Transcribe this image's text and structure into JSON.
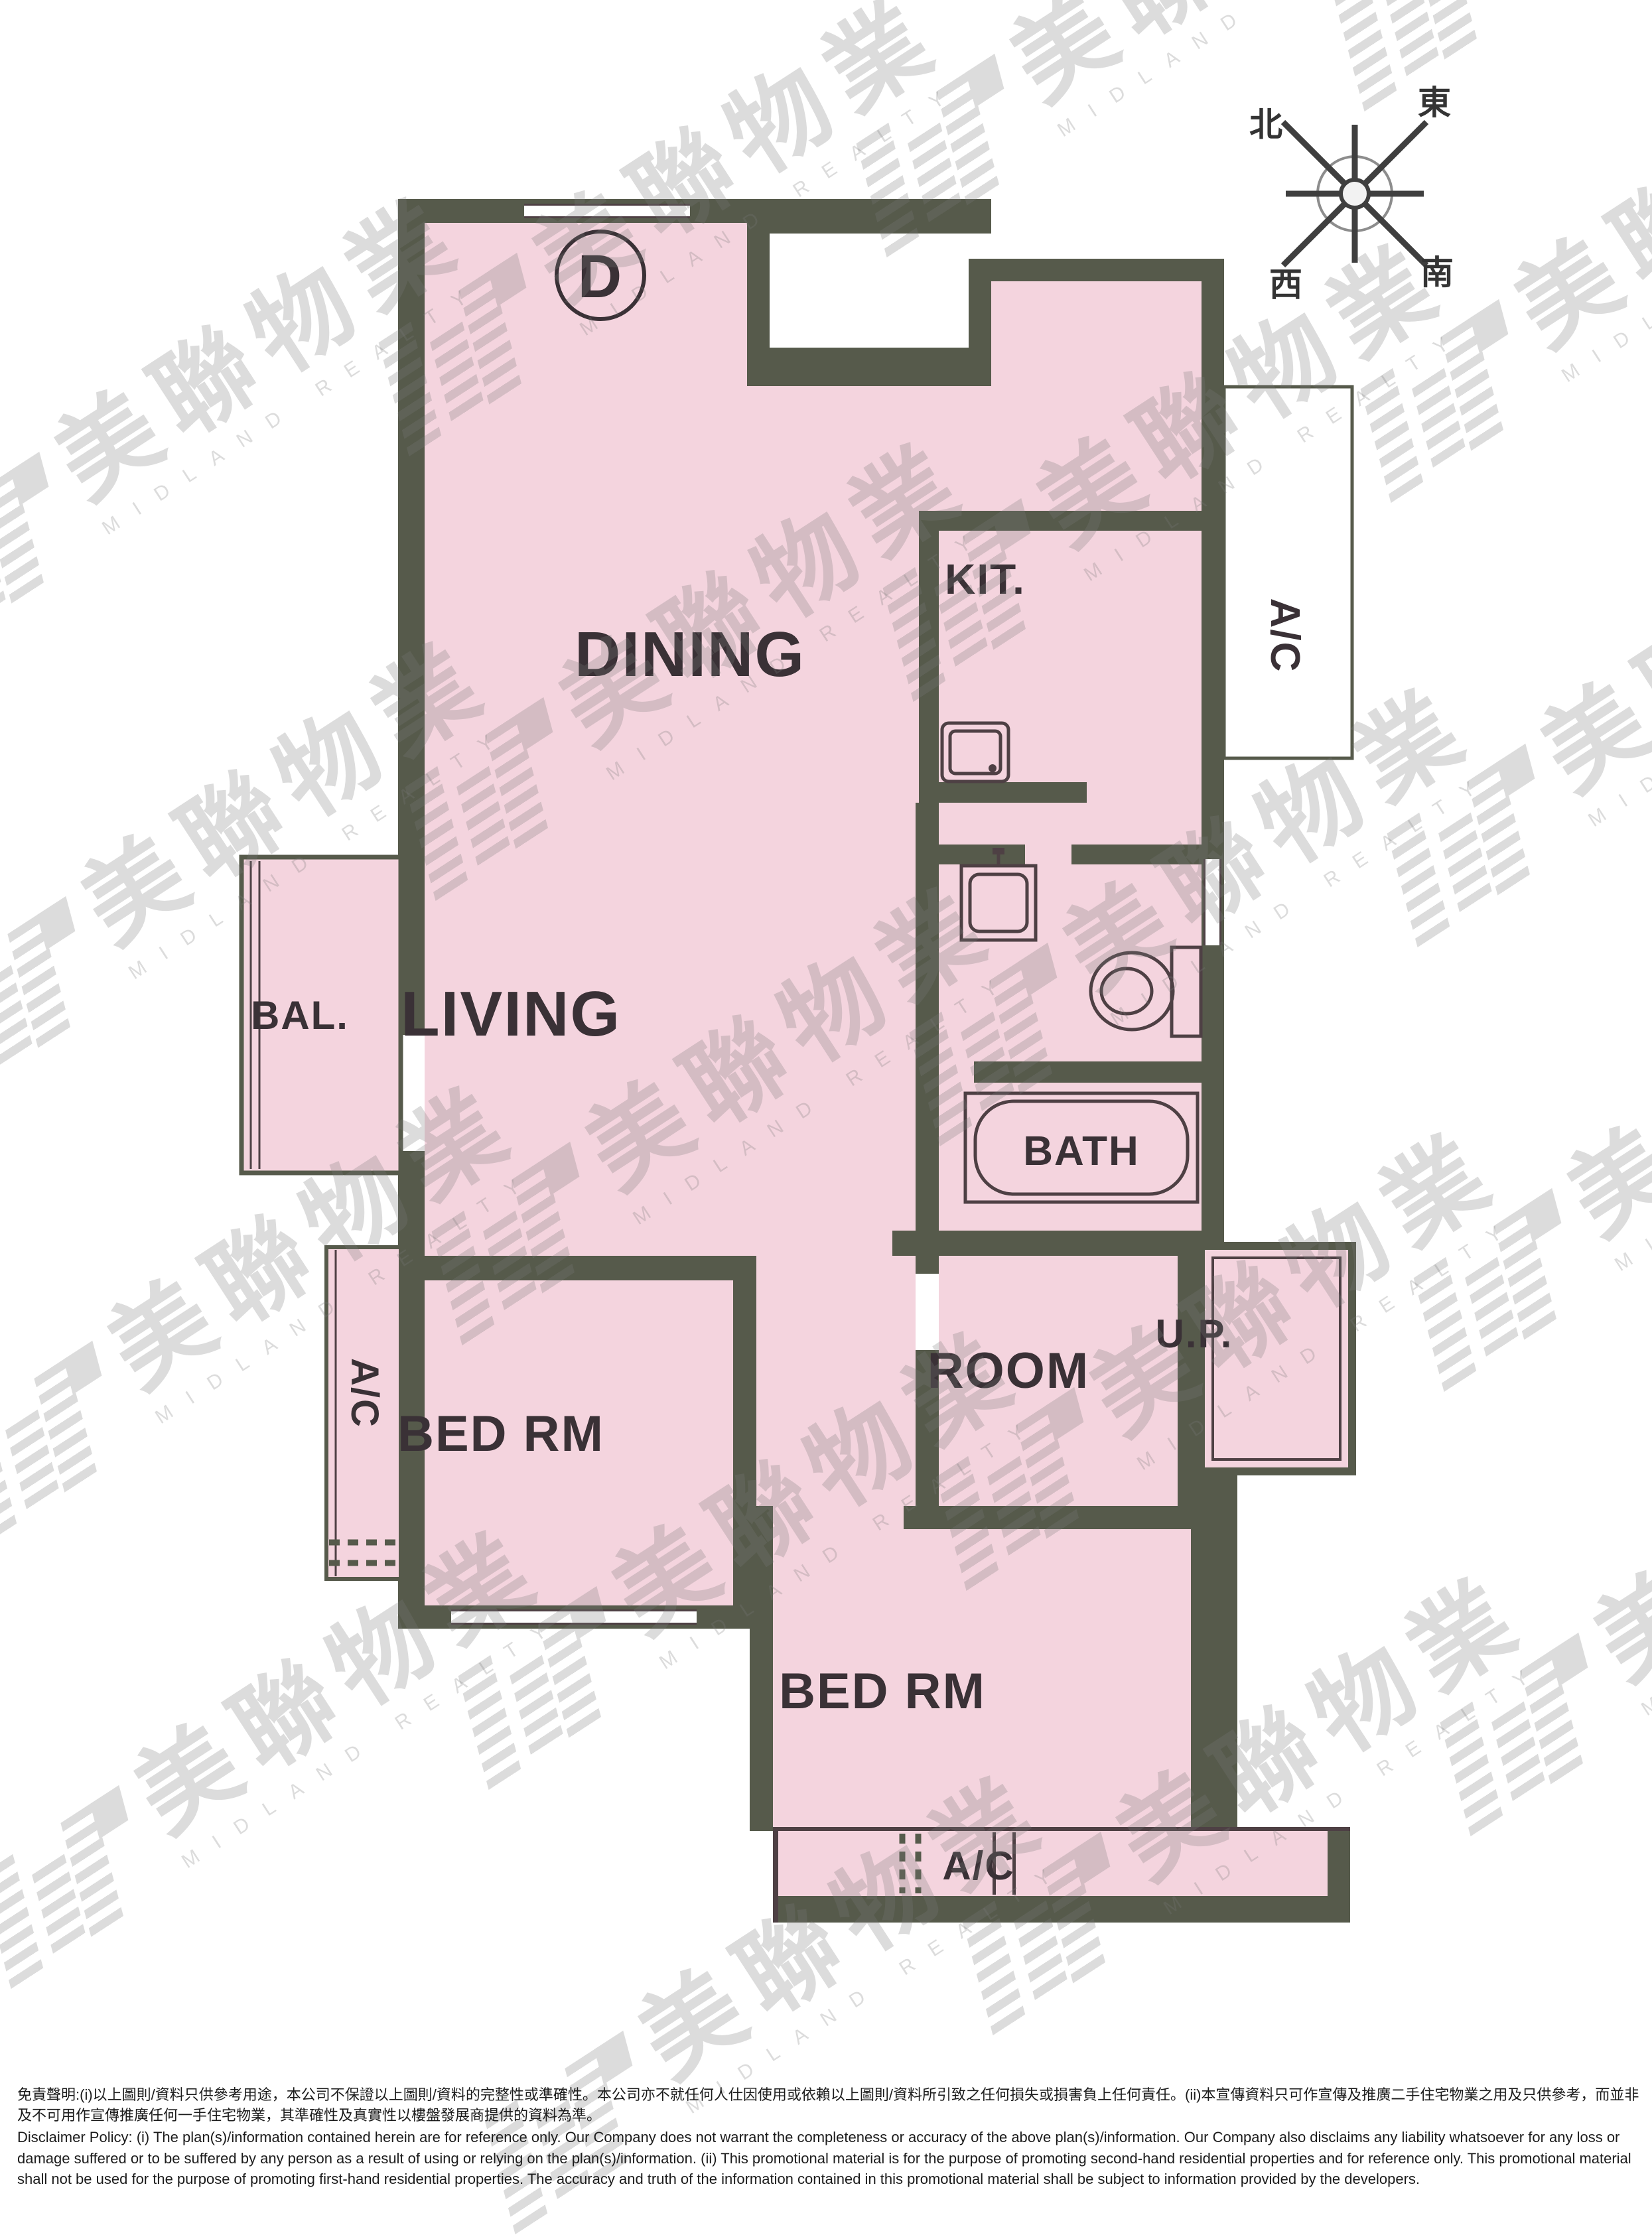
{
  "unit": {
    "label": "D"
  },
  "compass": {
    "north": "北",
    "east": "東",
    "west": "西",
    "south": "南"
  },
  "rooms": {
    "dining": "DINING",
    "living": "LIVING",
    "kitchen": "KIT.",
    "bath": "BATH",
    "balcony": "BAL.",
    "bed1": "BED RM",
    "bed2": "BED RM",
    "room": "ROOM",
    "up": "U.P.",
    "ac_right": "A/C",
    "ac_left": "A/C",
    "ac_bottom": "A/C"
  },
  "watermark": {
    "cjk": "美聯物業",
    "latin": "MIDLAND REALTY"
  },
  "colors": {
    "floor": "#f4d4de",
    "wall": "#565a4b",
    "line": "#4e4044",
    "label": "#3a3136",
    "wm": "#7a7a7a"
  },
  "disclaimer": {
    "zh": "免責聲明:(i)以上圖則/資料只供參考用途，本公司不保證以上圖則/資料的完整性或準確性。本公司亦不就任何人仕因使用或依賴以上圖則/資料所引致之任何損失或損害負上任何責任。(ii)本宣傳資料只可作宣傳及推廣二手住宅物業之用及只供參考，而並非及不可用作宣傳推廣任何一手住宅物業，其準確性及真實性以樓盤發展商提供的資料為準。",
    "en": "Disclaimer Policy: (i) The plan(s)/information contained herein are for reference only. Our Company does not warrant the completeness or accuracy of the above plan(s)/information. Our Company also disclaims any liability whatsoever for any loss or damage suffered or to be suffered by any person as a result of using or relying on the plan(s)/information. (ii) This promotional material is for the purpose of promoting second-hand residential properties and for reference only. This promotional material shall not be used for the purpose of promoting first-hand residential properties. The accuracy and truth of the information contained in this promotional material shall be subject to information provided by the developers."
  }
}
